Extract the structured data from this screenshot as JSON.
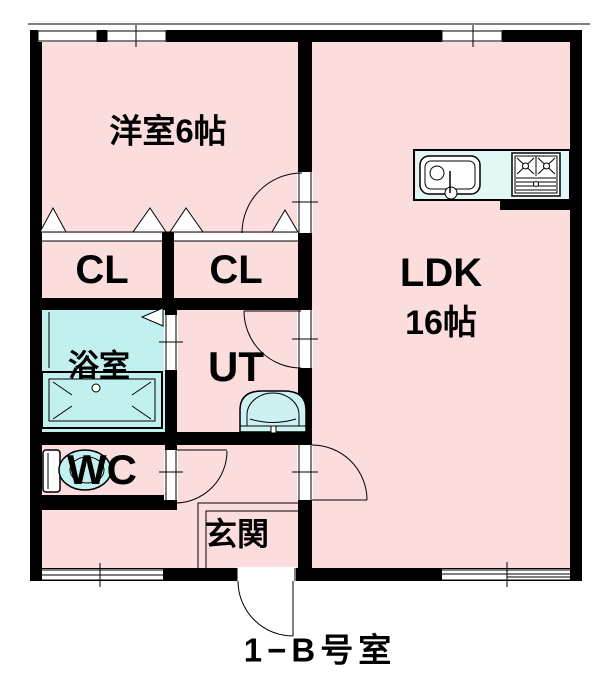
{
  "caption": "1−B号室",
  "rooms": [
    {
      "name": "western-room",
      "label": "洋室6帖"
    },
    {
      "name": "closet-left",
      "label": "CL"
    },
    {
      "name": "closet-right",
      "label": "CL"
    },
    {
      "name": "ldk",
      "label": "LDK",
      "size_label": "16帖"
    },
    {
      "name": "bathroom",
      "label": "浴室"
    },
    {
      "name": "utility",
      "label": "UT"
    },
    {
      "name": "toilet-room",
      "label": "WC"
    },
    {
      "name": "entrance",
      "label": "玄関"
    }
  ],
  "fixtures": [
    "kitchen-sink",
    "gas-stove",
    "bathtub",
    "toilet",
    "washbasin",
    "closet-folding-doors",
    "swing-doors",
    "sliding-windows",
    "entrance-door"
  ],
  "colors": {
    "wall": "#000000",
    "line": "#000000",
    "room_pink": "#fcdddd",
    "bath_cyan": "#c2f0ef",
    "fixture_cyan": "#cdf1f1",
    "counter_cyan": "#e2f6f6",
    "bg": "#ffffff"
  }
}
